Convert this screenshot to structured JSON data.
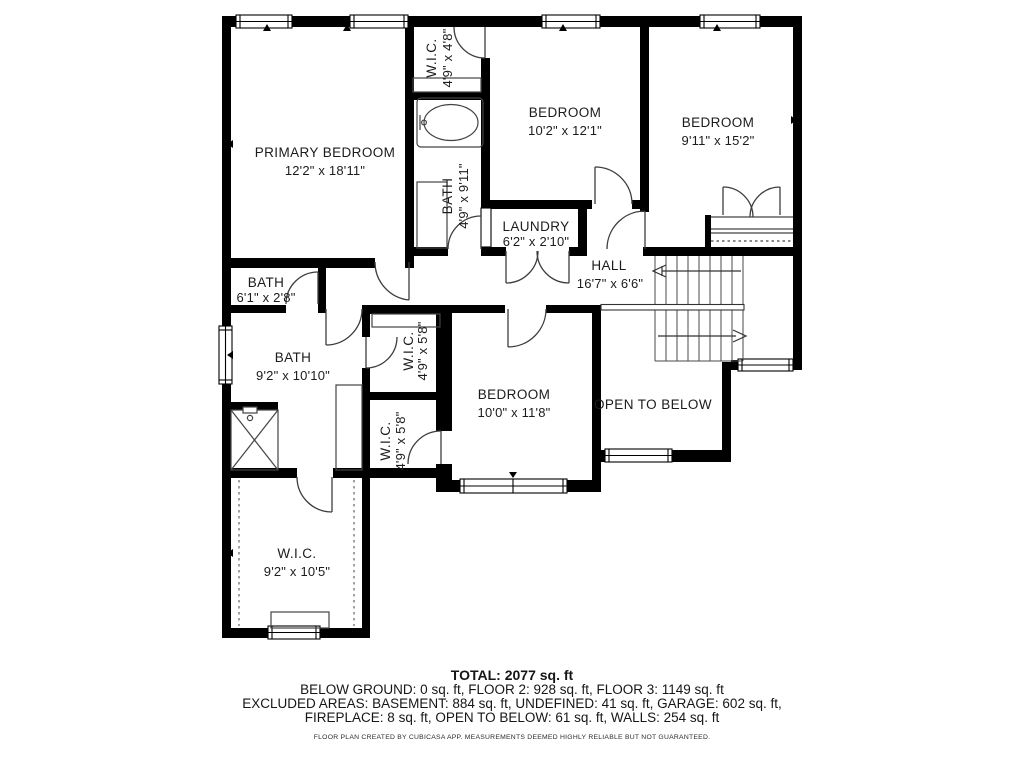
{
  "plan": {
    "rooms": [
      {
        "id": "primary-bedroom",
        "name": "PRIMARY BEDROOM",
        "dims": "12'2\" x 18'11\""
      },
      {
        "id": "wic-top",
        "name": "W.I.C.",
        "dims": "4'9\" x 4'8\""
      },
      {
        "id": "bath-middle",
        "name": "BATH",
        "dims": "4'9\" x 9'11\""
      },
      {
        "id": "bedroom-middle",
        "name": "BEDROOM",
        "dims": "10'2\" x 12'1\""
      },
      {
        "id": "bedroom-right",
        "name": "BEDROOM",
        "dims": "9'11\" x 15'2\""
      },
      {
        "id": "laundry",
        "name": "LAUNDRY",
        "dims": "6'2\" x 2'10\""
      },
      {
        "id": "hall",
        "name": "HALL",
        "dims": "16'7\" x 6'6\""
      },
      {
        "id": "bath-small",
        "name": "BATH",
        "dims": "6'1\" x 2'8\""
      },
      {
        "id": "bath-left",
        "name": "BATH",
        "dims": "9'2\" x 10'10\""
      },
      {
        "id": "wic-upper",
        "name": "W.I.C.",
        "dims": "4'9\" x 5'8\""
      },
      {
        "id": "wic-lower",
        "name": "W.I.C.",
        "dims": "4'9\" x 5'8\""
      },
      {
        "id": "bedroom-bottom",
        "name": "BEDROOM",
        "dims": "10'0\" x 11'8\""
      },
      {
        "id": "open-to-below",
        "name": "OPEN TO BELOW",
        "dims": ""
      },
      {
        "id": "wic-bottom",
        "name": "W.I.C.",
        "dims": "9'2\" x 10'5\""
      }
    ],
    "colors": {
      "wall": "#000000",
      "line": "#4a4a4a",
      "background": "#ffffff"
    }
  },
  "footer": {
    "total": "TOTAL: 2077 sq. ft",
    "line2": "BELOW GROUND: 0 sq. ft, FLOOR 2: 928 sq. ft, FLOOR 3: 1149 sq. ft",
    "line3": "EXCLUDED AREAS: BASEMENT: 884 sq. ft, UNDEFINED: 41 sq. ft, GARAGE: 602 sq. ft,",
    "line4": "FIREPLACE: 8 sq. ft, OPEN TO BELOW: 61 sq. ft, WALLS: 254 sq. ft",
    "disclaimer": "FLOOR PLAN CREATED BY CUBICASA APP. MEASUREMENTS DEEMED HIGHLY RELIABLE BUT NOT GUARANTEED."
  }
}
